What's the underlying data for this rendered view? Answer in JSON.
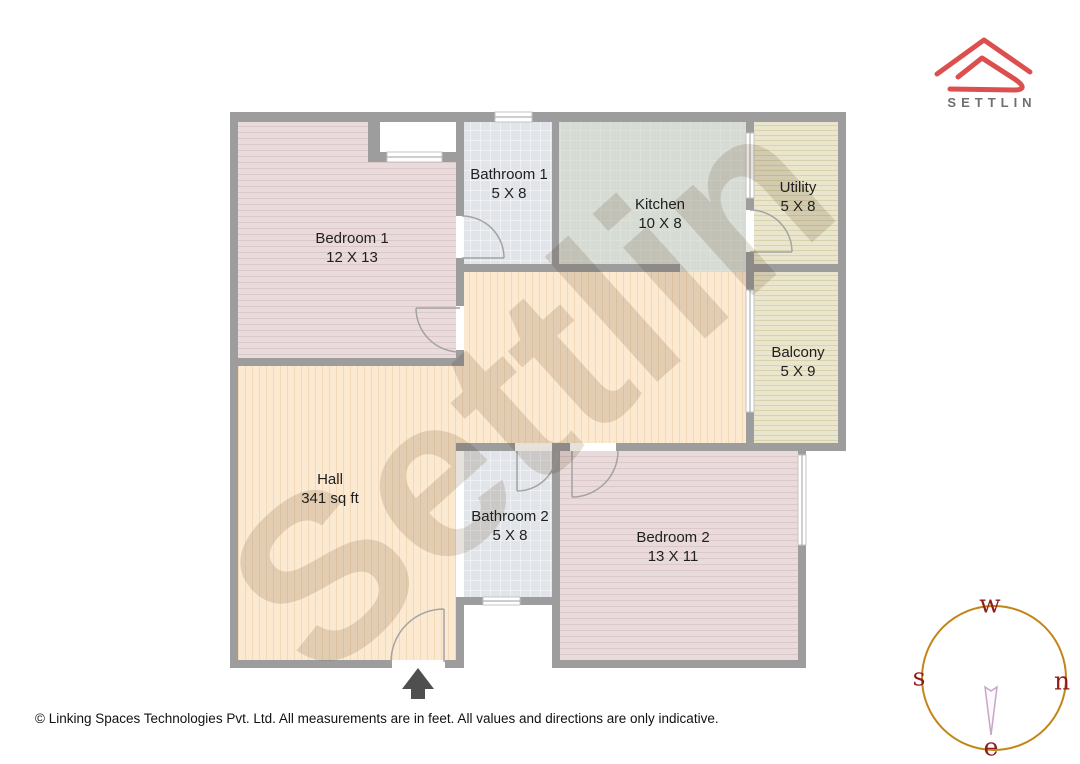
{
  "brand": {
    "logo_text": "SETTLIN",
    "logo_color": "#dd4f4f",
    "logo_text_color": "#6f6f6f"
  },
  "watermark": {
    "text": "Settlin"
  },
  "rooms": [
    {
      "id": "bedroom-1",
      "name": "Bedroom 1",
      "dimensions": "12 X 13"
    },
    {
      "id": "bathroom-1",
      "name": "Bathroom 1",
      "dimensions": "5 X 8"
    },
    {
      "id": "kitchen",
      "name": "Kitchen",
      "dimensions": "10 X 8"
    },
    {
      "id": "utility",
      "name": "Utility",
      "dimensions": "5 X 8"
    },
    {
      "id": "balcony",
      "name": "Balcony",
      "dimensions": "5 X 9"
    },
    {
      "id": "hall",
      "name": "Hall",
      "dimensions": "341 sq ft"
    },
    {
      "id": "bathroom-2",
      "name": "Bathroom 2",
      "dimensions": "5 X 8"
    },
    {
      "id": "bedroom-2",
      "name": "Bedroom 2",
      "dimensions": "13 X 11"
    }
  ],
  "compass": {
    "top_label": "w",
    "left_label": "s",
    "right_label": "n",
    "bottom_label": "e",
    "circle_color": "#c28618",
    "letter_color": "#8e1c1c"
  },
  "footer": {
    "copyright": "© Linking Spaces Technologies Pvt. Ltd. All measurements are in feet. All values and directions are only indicative."
  },
  "colors": {
    "wall": "#9d9d9d",
    "bedroom_floor": "#e9dbdb",
    "bathroom_floor": "#e1e4e9",
    "kitchen_floor": "#d6dbd4",
    "utility_balcony_floor": "#eae6cd",
    "hall_floor": "#fbe9d1",
    "entrance_arrow": "#4f4f4f",
    "door_arc": "#a3a3a3"
  }
}
